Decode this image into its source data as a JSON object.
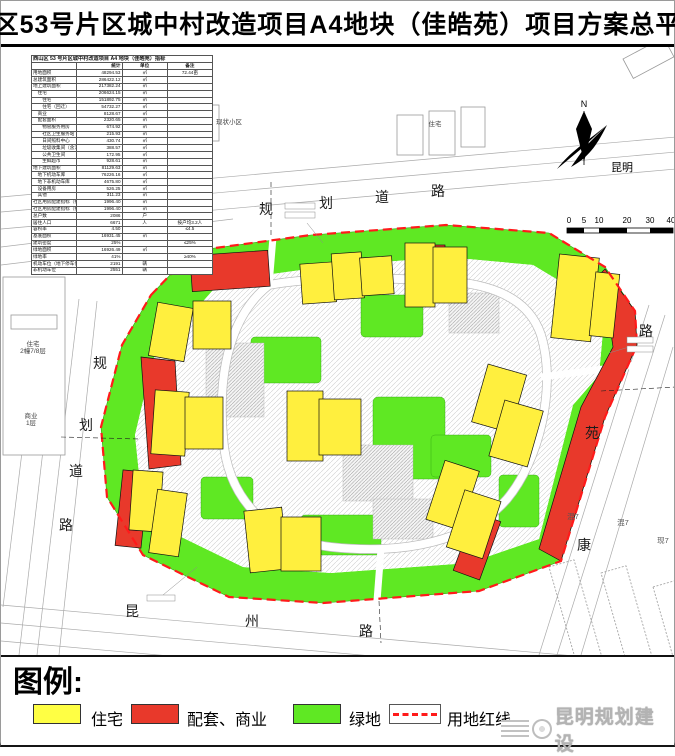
{
  "title": "西山区53号片区城中村改造项目A4地块（佳皓苑）项目方案总平面图",
  "colors": {
    "residential": "#ffef3e",
    "commercial": "#e8392b",
    "green_space": "#5fe823",
    "redline": "#ff1a1a"
  },
  "table": {
    "caption": "西山区 53 号片区城中村改造项目 A4 地块（佳皓苑）指标",
    "columns": {
      "stat": "统计",
      "unit": "单位",
      "note": "备注"
    },
    "rows": [
      {
        "label": "用地面积",
        "value": "48294.53",
        "unit": "㎡",
        "note": "72.44亩"
      },
      {
        "label": "总建筑面积",
        "value": "286422.12",
        "unit": "㎡",
        "note": ""
      },
      {
        "label": "地上建筑面积",
        "value": "217382.24",
        "unit": "㎡",
        "note": ""
      },
      {
        "label": "　住宅",
        "value": "206624.15",
        "unit": "㎡",
        "note": ""
      },
      {
        "label": "　　住宅",
        "value": "151892.75",
        "unit": "㎡",
        "note": ""
      },
      {
        "label": "　　住宅（回迁）",
        "value": "54732.27",
        "unit": "㎡",
        "note": ""
      },
      {
        "label": "　商业",
        "value": "8128.67",
        "unit": "㎡",
        "note": ""
      },
      {
        "label": "　配套面积",
        "value": "2320.65",
        "unit": "㎡",
        "note": ""
      },
      {
        "label": "　　物管服务用房",
        "value": "674.92",
        "unit": "㎡",
        "note": ""
      },
      {
        "label": "　　社区卫生服务站",
        "value": "215.93",
        "unit": "㎡",
        "note": ""
      },
      {
        "label": "　　日间照料中心",
        "value": "430.74",
        "unit": "㎡",
        "note": ""
      },
      {
        "label": "　　垃圾收集间（含污水处理间）",
        "value": "388.57",
        "unit": "㎡",
        "note": ""
      },
      {
        "label": "　　公共卫生间",
        "value": "172.95",
        "unit": "㎡",
        "note": ""
      },
      {
        "label": "　　生鲜超市",
        "value": "928.61",
        "unit": "㎡",
        "note": ""
      },
      {
        "label": "地下建筑面积",
        "value": "81129.63",
        "unit": "㎡",
        "note": ""
      },
      {
        "label": "　地下机动车库",
        "value": "76226.16",
        "unit": "㎡",
        "note": ""
      },
      {
        "label": "　地下非机动车库",
        "value": "4675.80",
        "unit": "㎡",
        "note": ""
      },
      {
        "label": "　设备用房",
        "value": "526.25",
        "unit": "㎡",
        "note": ""
      },
      {
        "label": "　其他",
        "value": "311.23",
        "unit": "㎡",
        "note": ""
      },
      {
        "label": "社区用房配建指标（按规划核定）",
        "value": "1996.40",
        "unit": "㎡",
        "note": ""
      },
      {
        "label": "社区用房配建指标（按实际核算）",
        "value": "1996.40",
        "unit": "㎡",
        "note": ""
      },
      {
        "label": "总户数",
        "value": "2086",
        "unit": "户",
        "note": ""
      },
      {
        "label": "居住人口",
        "value": "6671",
        "unit": "人",
        "note": "按户均3.2人"
      },
      {
        "label": "容积率",
        "value": "4.50",
        "unit": "",
        "note": "≤4.5"
      },
      {
        "label": "基底面积",
        "value": "16931.45",
        "unit": "㎡",
        "note": ""
      },
      {
        "label": "建筑密度",
        "value": "25%",
        "unit": "",
        "note": "≤25%"
      },
      {
        "label": "绿地面积",
        "value": "16926.49",
        "unit": "㎡",
        "note": ""
      },
      {
        "label": "绿地率",
        "value": "41%",
        "unit": "",
        "note": "≥40%"
      },
      {
        "label": "机动车位（地下停车位）",
        "value": "2191",
        "unit": "辆",
        "note": ""
      },
      {
        "label": "非机动车位",
        "value": "2551",
        "unit": "辆",
        "note": ""
      }
    ]
  },
  "map": {
    "north_letter": "N",
    "city": "昆明",
    "scale_ticks": [
      "0",
      "5",
      "10",
      "20",
      "30",
      "40"
    ],
    "roads": {
      "top": [
        "规",
        "划",
        "道",
        "路"
      ],
      "left": [
        "规",
        "划",
        "道",
        "路"
      ],
      "bottom": [
        "昆",
        "州",
        "路"
      ],
      "right": [
        "路",
        "苑",
        "康"
      ]
    },
    "context": {
      "left_building_line1": "住宅",
      "left_building_line2": "2幢7/8层",
      "left_commercial_line1": "商业",
      "left_commercial_line2": "1层",
      "neighborhood": "现状小区",
      "top_residential": "住宅",
      "right_mixed_1": "混7",
      "right_mixed_2": "混7",
      "right_existing": "现7"
    }
  },
  "legend": {
    "heading": "图例:",
    "items": [
      {
        "label": "住宅",
        "color": "#ffff44"
      },
      {
        "label": "配套、商业",
        "color": "#e8392b"
      },
      {
        "label": "绿地",
        "color": "#5fe823"
      }
    ],
    "redline_label": "用地红线",
    "watermark": "昆明规划建设"
  }
}
